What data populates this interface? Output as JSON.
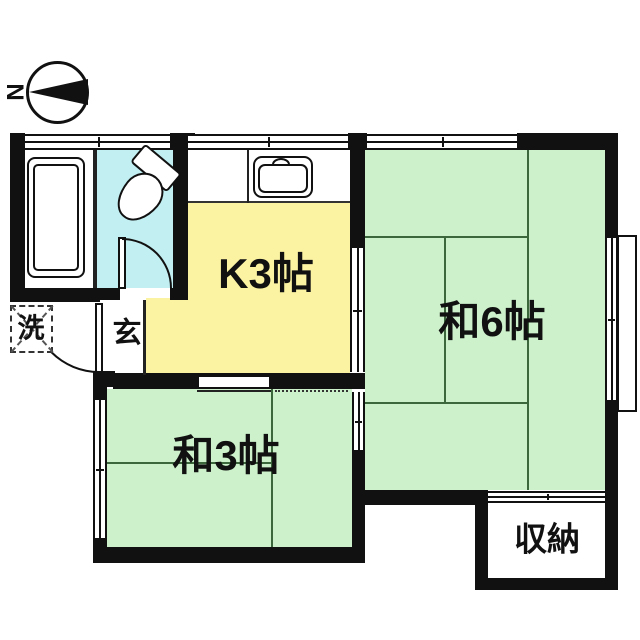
{
  "compass": {
    "label": "N"
  },
  "rooms": {
    "kitchen": {
      "label": "K3帖",
      "color": "#fbf3a2"
    },
    "tatami6": {
      "label": "和6帖",
      "color": "#cdf2cb"
    },
    "tatami3": {
      "label": "和3帖",
      "color": "#cdf2cb"
    },
    "entrance": {
      "label": "玄"
    },
    "washer": {
      "label": "洗"
    },
    "storage": {
      "label": "収納"
    },
    "toilet": {
      "color": "#c2eff2"
    },
    "bath": {
      "color": "#ffffff"
    }
  },
  "colors": {
    "wall": "#111111",
    "tatami_line": "#3c663c",
    "text": "#111111",
    "background": "#ffffff"
  }
}
